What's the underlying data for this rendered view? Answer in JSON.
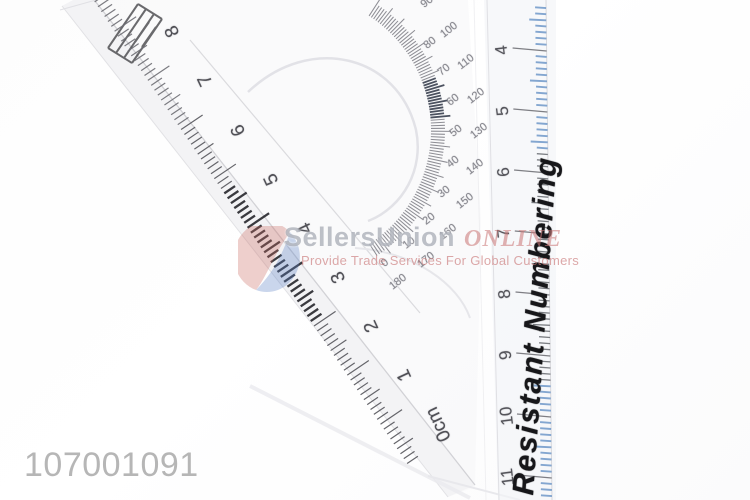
{
  "product_photo": {
    "sku": "107001091",
    "watermark": {
      "brand": "SellersUnion",
      "brand_suffix": "ONLINE",
      "tagline": "Provide Trade Services For Global Customers",
      "logo_red": "#c96a60",
      "logo_blue": "#5b7fc4"
    },
    "triangle_ruler": {
      "cm_labels": [
        "8",
        "7",
        "6",
        "5",
        "4",
        "3",
        "2",
        "1",
        "0cm"
      ]
    },
    "straight_ruler": {
      "printed_text": "Resistant Numbering",
      "cm_labels": [
        "4",
        "5",
        "6",
        "7",
        "8",
        "9",
        "10",
        "11"
      ],
      "tick_color": "#6f98c9",
      "print_color": "#17171a"
    },
    "protractor": {
      "degree_labels": [
        {
          "outer": "90",
          "inner": ""
        },
        {
          "outer": "100",
          "inner": "80"
        },
        {
          "outer": "110",
          "inner": "70"
        },
        {
          "outer": "120",
          "inner": "60"
        },
        {
          "outer": "130",
          "inner": "50"
        },
        {
          "outer": "140",
          "inner": "40"
        },
        {
          "outer": "150",
          "inner": "30"
        },
        {
          "outer": "160",
          "inner": "20"
        },
        {
          "outer": "170",
          "inner": "10"
        },
        {
          "outer": "180",
          "inner": "0"
        }
      ]
    }
  }
}
